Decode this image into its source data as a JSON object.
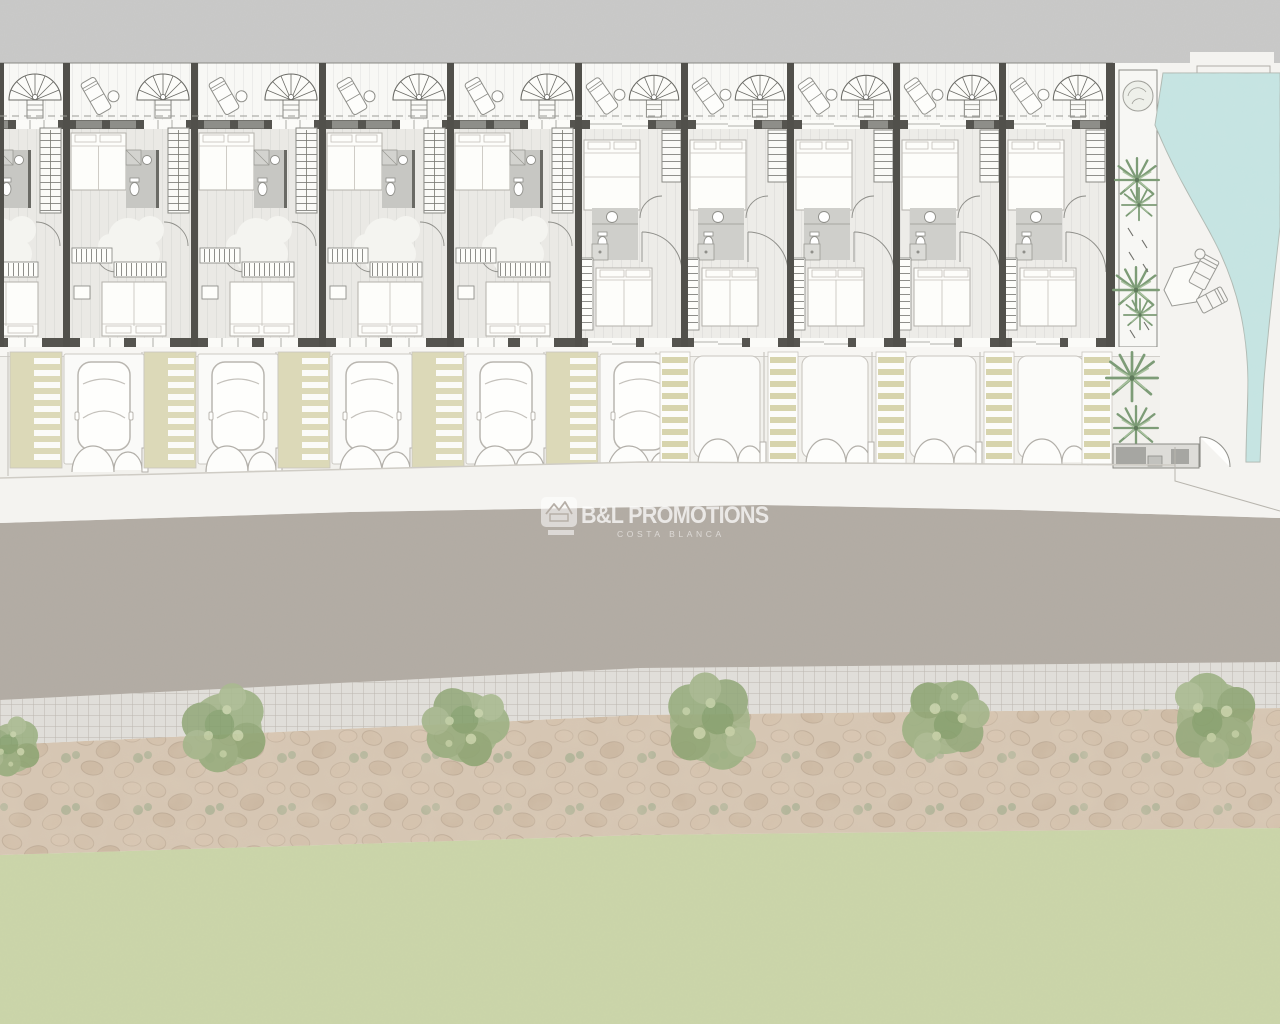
{
  "page": {
    "title": "Townhouse development site plan",
    "type": "architectural-site-plan"
  },
  "watermark": {
    "brand": "B&L PROMOTIONS",
    "tagline": "COSTA BLANCA",
    "icon": "house-logo-icon"
  },
  "plan": {
    "townhouse_units_left_section": 5,
    "townhouse_units_right_section": 5,
    "terrace_features": [
      "spiral-staircase",
      "sun-lounger",
      "side-table"
    ],
    "room_features": [
      "double-bed",
      "twin-beds",
      "bathroom",
      "shower",
      "toilet",
      "washbasin",
      "straight-staircase",
      "wardrobe"
    ],
    "street": {
      "parked_cars": 5,
      "empty_driveways": 4,
      "striped_walkways": 9,
      "bin_store": 1
    },
    "landscape": {
      "street_trees": 6,
      "palm_planters": 4,
      "swimming_pool": 1,
      "lawn_band": 1,
      "stone_talus_band": 1,
      "tiled_sidewalk_band": 1
    }
  },
  "colors": {
    "topBand": "#c9c9c8",
    "plot": "#f2f1ed",
    "terrace": "#f8f8f5",
    "floorA": "#eae9e5",
    "floorB": "#edece8",
    "wall": "#51504b",
    "facade": "#55544f",
    "planter": "#8e8e89",
    "bath": "#c7c7c3",
    "bathB": "#cfcfcb",
    "fixtureLine": "#b4b1ab",
    "stripeBeige": "#d9d6b2",
    "stripePanel": "#dcd9b8",
    "walk": "#f4f3f0",
    "road": "#b3aca4",
    "tile": "#e0ded9",
    "tileLine": "#c7c3bc",
    "rock": "#d6c6b3",
    "stone": "#cdb9a4",
    "moss": "#a9b194",
    "grass": "#cbd5a9",
    "tree": "#9cb183",
    "treeDark": "#84a06c",
    "water": "#c7e4e2",
    "waterDeep": "#9ccfcb",
    "palm": "#7d9c77",
    "line": "#c9c6c0",
    "watermark": "#ffffff"
  }
}
